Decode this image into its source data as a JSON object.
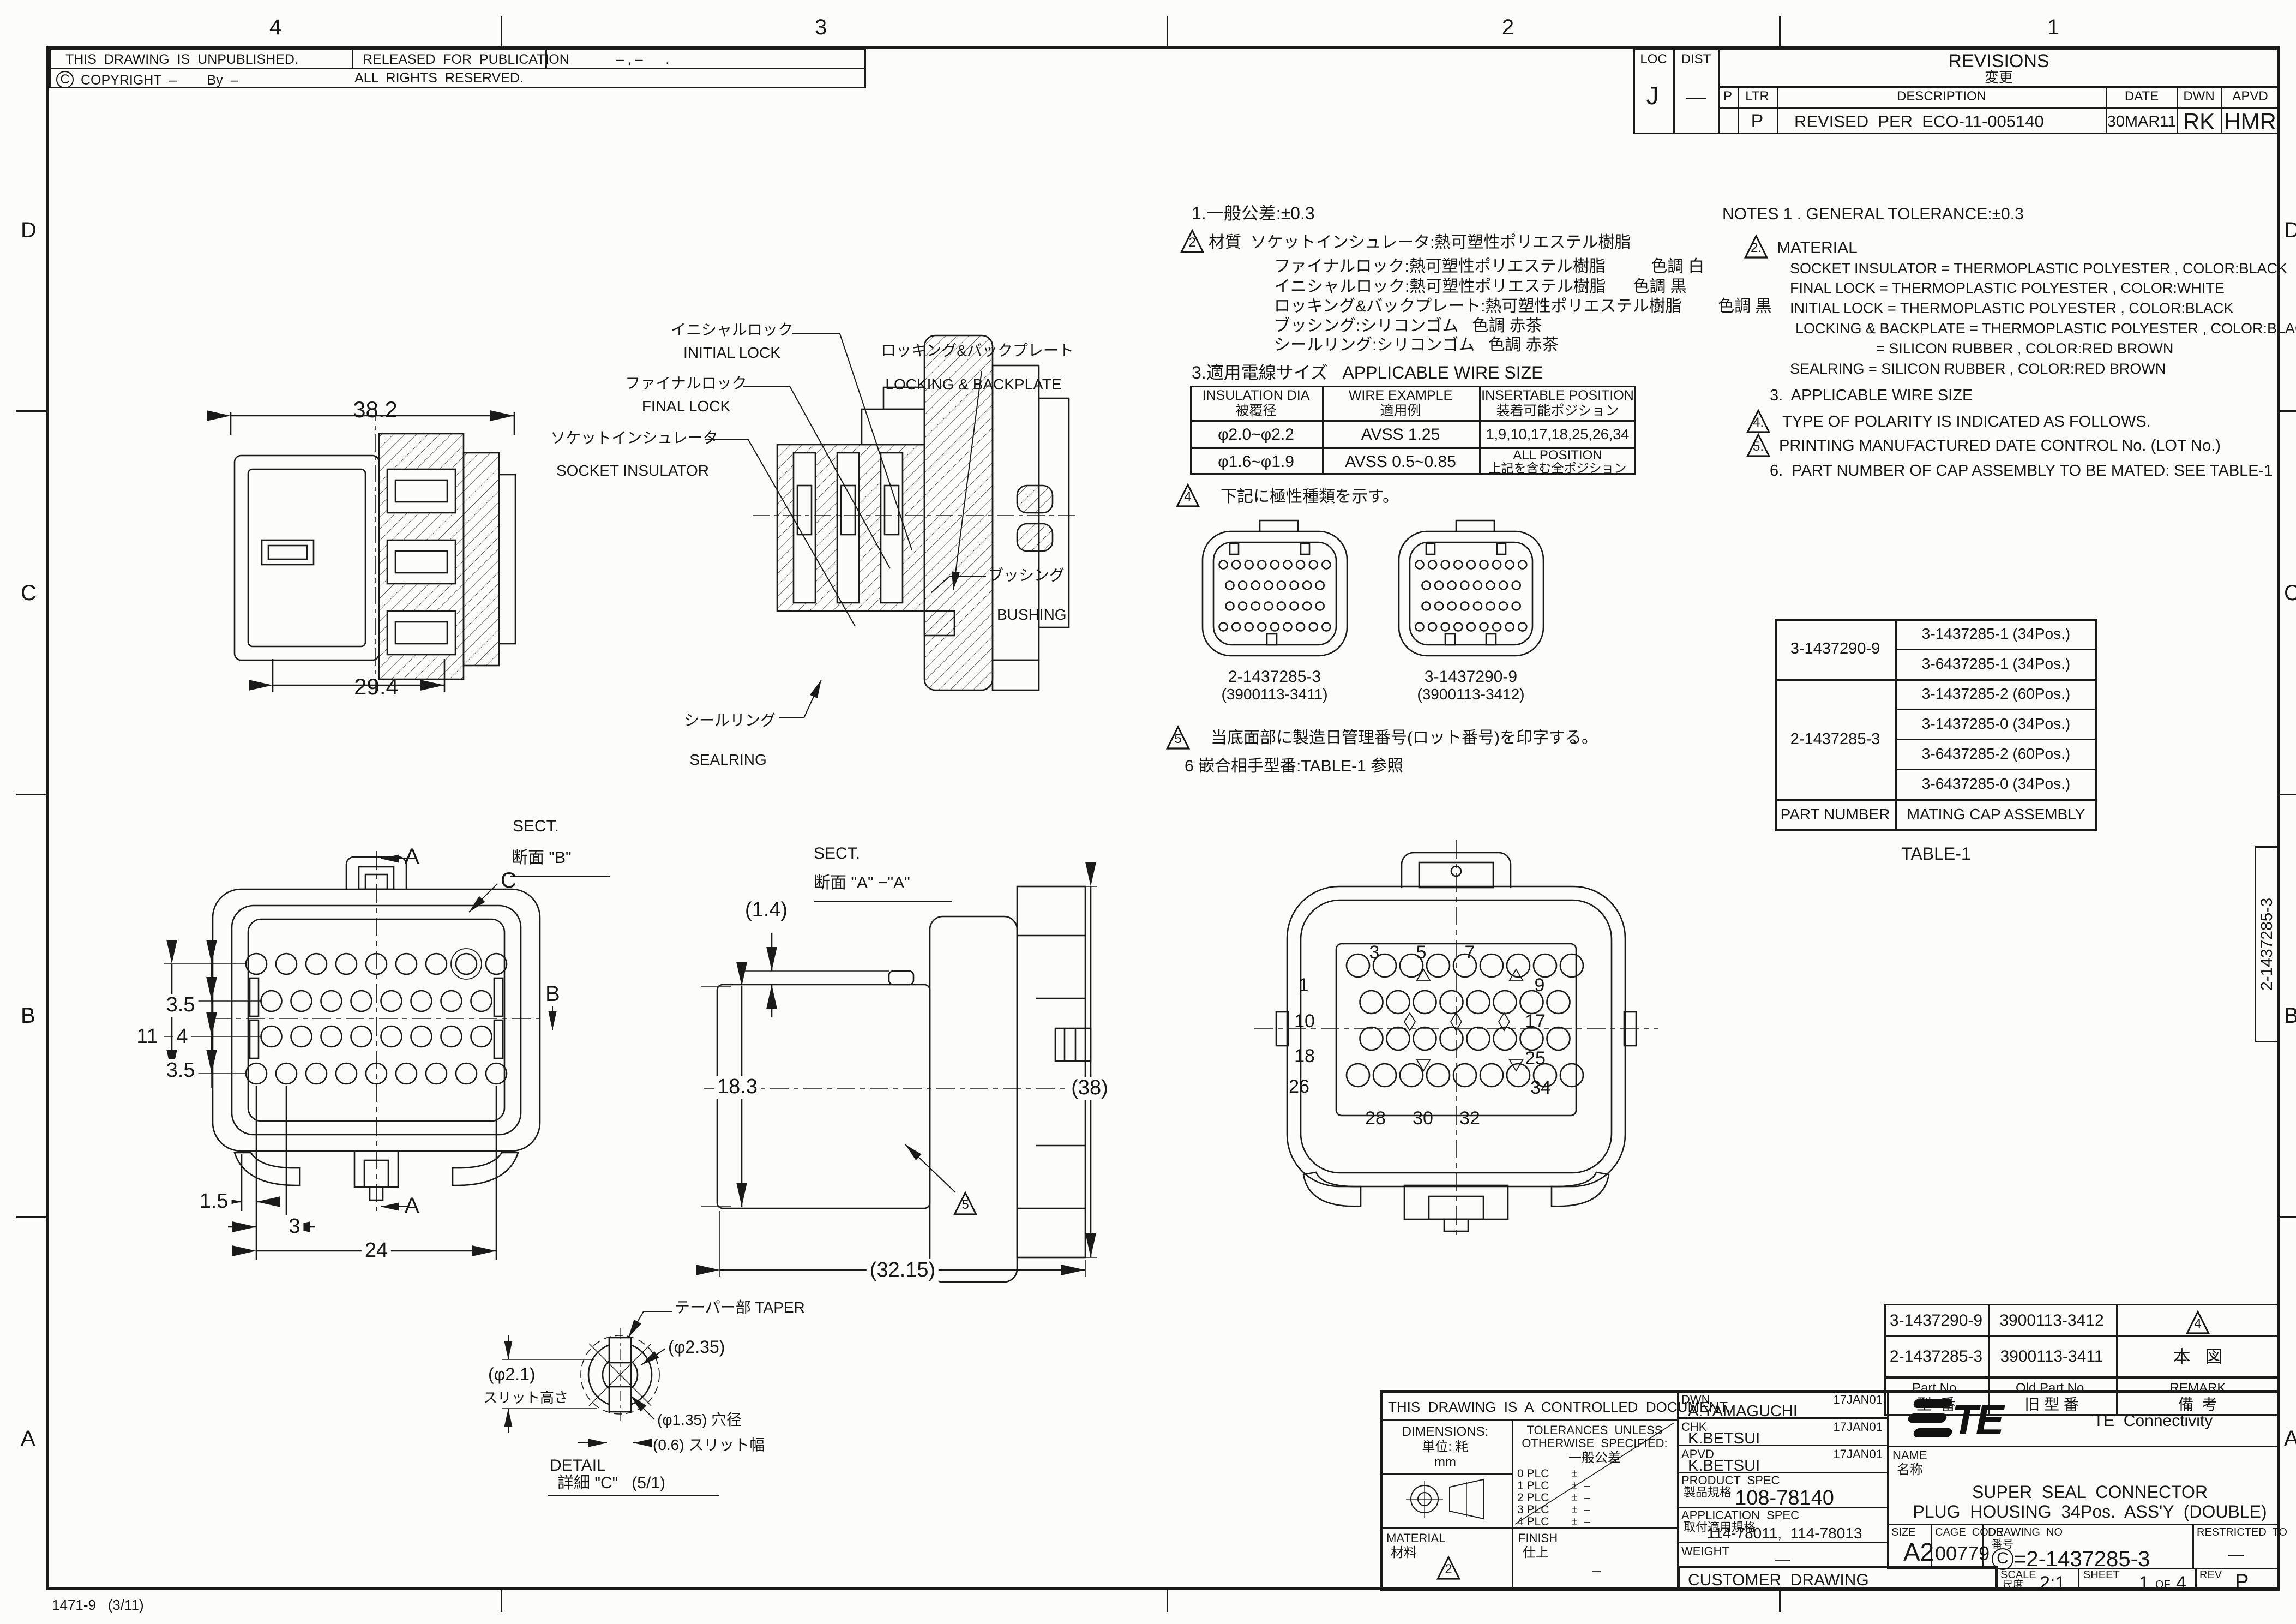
{
  "sheet": {
    "zones_top": [
      "4",
      "3",
      "2",
      "1"
    ],
    "zones_left": [
      "D",
      "C",
      "B",
      "A"
    ],
    "zones_right": [
      "D",
      "C",
      "B",
      "A"
    ],
    "form_note": "1471-9   (3/11)",
    "edge_label": "2-1437285-3"
  },
  "header": {
    "unpublished": "THIS  DRAWING  IS  UNPUBLISHED.",
    "released": "RELEASED  FOR  PUBLICATION",
    "released_value": "– , –      .",
    "copyright_c": "C",
    "copyright": "COPYRIGHT  –        By  –",
    "rights": "ALL  RIGHTS  RESERVED."
  },
  "revisions": {
    "loc_label": "LOC",
    "loc": "J",
    "dist_label": "DIST",
    "dist": "—",
    "title": "REVISIONS",
    "title_jp": "変更",
    "col_p": "P",
    "col_ltr": "LTR",
    "col_desc": "DESCRIPTION",
    "col_date": "DATE",
    "col_dwn": "DWN",
    "col_apvd": "APVD",
    "row": {
      "ltr": "P",
      "desc": "REVISED  PER  ECO-11-005140",
      "date": "30MAR11",
      "dwn": "RK",
      "apvd": "HMR"
    }
  },
  "notes_jp": {
    "n1": "1.一般公差:±0.3",
    "n2_flag": "2",
    "n2": "材質  ソケットインシュレータ:熱可塑性ポリエステル樹脂",
    "n2a": "ファイナルロック:熱可塑性ポリエステル樹脂          色調 白",
    "n2b": "イニシャルロック:熱可塑性ポリエステル樹脂      色調 黒",
    "n2c": "ロッキング&バックプレート:熱可塑性ポリエステル樹脂        色調 黒",
    "n2d": "ブッシング:シリコンゴム   色調 赤茶",
    "n2e": "シールリング:シリコンゴム   色調 赤茶",
    "n3": "3.適用電線サイズ   APPLICABLE WIRE SIZE",
    "n4_flag": "4",
    "n4": "下記に極性種類を示す。",
    "n5_flag": "5",
    "n5": "当底面部に製造日管理番号(ロット番号)を印字する。",
    "n6": "6 嵌合相手型番:TABLE-1 参照"
  },
  "wire_table": {
    "h1a": "INSULATION DIA",
    "h1b": "被覆径",
    "h2a": "WIRE EXAMPLE",
    "h2b": "適用例",
    "h3a": "INSERTABLE POSITION",
    "h3b": "装着可能ポジション",
    "r1c1": "φ2.0~φ2.2",
    "r1c2": "AVSS 1.25",
    "r1c3": "1,9,10,17,18,25,26,34",
    "r2c1": "φ1.6~φ1.9",
    "r2c2": "AVSS 0.5~0.85",
    "r2c3a": "ALL POSITION",
    "r2c3b": "上記を含む全ポジション"
  },
  "polarity": {
    "left_pn": "2-1437285-3",
    "left_old": "(3900113-3411)",
    "right_pn": "3-1437290-9",
    "right_old": "(3900113-3412)"
  },
  "notes_en": {
    "n1": "NOTES 1 . GENERAL TOLERANCE:±0.3",
    "n2_flag": "2.",
    "n2": "MATERIAL",
    "m1": "SOCKET INSULATOR = THERMOPLASTIC POLYESTER , COLOR:BLACK",
    "m2": "FINAL LOCK = THERMOPLASTIC POLYESTER , COLOR:WHITE",
    "m3": "INITIAL LOCK = THERMOPLASTIC POLYESTER , COLOR:BLACK",
    "m4": "LOCKING & BACKPLATE = THERMOPLASTIC POLYESTER , COLOR:BLACK",
    "m5": "= SILICON RUBBER , COLOR:RED BROWN",
    "m6": "SEALRING = SILICON RUBBER , COLOR:RED BROWN",
    "n3": "3.  APPLICABLE WIRE SIZE",
    "n4_flag": "4.",
    "n4": "TYPE OF POLARITY IS INDICATED AS FOLLOWS.",
    "n5_flag": "5.",
    "n5": "PRINTING MANUFACTURED DATE CONTROL No. (LOT No.)",
    "n6": "6.  PART NUMBER OF CAP ASSEMBLY TO BE MATED: SEE TABLE-1"
  },
  "table1": {
    "group1_pn": "3-1437290-9",
    "group2_pn": "2-1437285-3",
    "caps": [
      "3-1437285-1 (34Pos.)",
      "3-6437285-1 (34Pos.)",
      "3-1437285-2 (60Pos.)",
      "3-1437285-0 (34Pos.)",
      "3-6437285-2 (60Pos.)",
      "3-6437285-0 (34Pos.)"
    ],
    "footer_left": "PART NUMBER",
    "footer_right": "MATING CAP ASSEMBLY",
    "caption": "TABLE-1"
  },
  "callouts": {
    "initial_jp": "イニシャルロック",
    "initial_en": "INITIAL LOCK",
    "final_jp": "ファイナルロック",
    "final_en": "FINAL LOCK",
    "socket_jp": "ソケットインシュレータ",
    "socket_en": "SOCKET INSULATOR",
    "locking_jp": "ロッキング&バックプレート",
    "locking_en": "LOCKING & BACKPLATE",
    "bushing_jp": "ブッシング",
    "bushing_en": "BUSHING",
    "sealring_jp": "シールリング",
    "sealring_en": "SEALRING",
    "taper": "テーパー部 TAPER"
  },
  "sect_b": {
    "label1": "SECT.",
    "label2": "断面 \"B\"",
    "dim_top": "38.2",
    "dim_bottom": "29.4"
  },
  "sect_aa": {
    "label1": "SECT.",
    "label2": "断面 \"A\" −\"A\""
  },
  "front_view": {
    "d35a": "3.5",
    "d11": "11",
    "d4": "4",
    "d35b": "3.5",
    "d15": "1.5",
    "d3": "3",
    "d24": "24",
    "a_top": "A",
    "a_bottom": "A",
    "b": "B",
    "c": "C"
  },
  "side_view": {
    "d14": "(1.4)",
    "d183": "18.3",
    "d38": "(38)",
    "d3215": "(32.15)",
    "flag": "5"
  },
  "rear_view": {
    "p1": "1",
    "p3": "3",
    "p5": "5",
    "p7": "7",
    "p9": "9",
    "p10": "10",
    "p17": "17",
    "p18": "18",
    "p25": "25",
    "p26": "26",
    "p34": "34",
    "p28": "28",
    "p30": "30",
    "p32": "32"
  },
  "detail_c": {
    "d235": "(φ2.35)",
    "d21": "(φ2.1)",
    "slit_h": "スリット高さ",
    "d135": "(φ1.35) 穴径",
    "d06": "(0.6) スリット幅",
    "label1": "DETAIL",
    "label2": "詳細 \"C\"   (5/1)"
  },
  "part_table": {
    "r1c1": "3-1437290-9",
    "r1c2": "3900113-3412",
    "r1_flag": "4",
    "r2c1": "2-1437285-3",
    "r2c2": "3900113-3411",
    "r2c3": "本   図",
    "h1a": "Part No.",
    "h1b": "型  番",
    "h2a": "Old Part No.",
    "h2b": "旧 型 番",
    "h3a": "REMARK",
    "h3b": "備  考"
  },
  "title_block": {
    "controlled": "THIS  DRAWING  IS  A  CONTROLLED  DOCUMENT.",
    "dwn_label": "DWN",
    "dwn_name": "A.YAMAGUCHI",
    "dwn_date": "17JAN01",
    "chk_label": "CHK",
    "chk_name": "K.BETSUI",
    "chk_date": "17JAN01",
    "apvd_label": "APVD",
    "apvd_name": "K.BETSUI",
    "apvd_date": "17JAN01",
    "dim_label": "DIMENSIONS:",
    "units_jp": "単位: 粍",
    "units": "mm",
    "tol1": "TOLERANCES  UNLESS",
    "tol2": "OTHERWISE  SPECIFIED:",
    "tol3": "一般公差",
    "plc0": "0 PLC       ±",
    "plc1": "1 PLC       ±  –",
    "plc2": "2 PLC       ±  –",
    "plc3": "3 PLC       ±  –",
    "plc4": "4 PLC       ±  –",
    "angles": "ANGLES            ±  –",
    "material_label": "MATERIAL",
    "material_jp": "材料",
    "material_flag": "2",
    "finish_label": "FINISH",
    "finish_jp": "仕上",
    "finish_value": "–",
    "product_label": "PRODUCT  SPEC",
    "product_jp": "製品規格",
    "product": "108-78140",
    "app_label": "APPLICATION  SPEC",
    "app_jp": "取付適用規格",
    "app": "114-78011,  114-78013",
    "weight_label": "WEIGHT",
    "weight": "—",
    "customer": "CUSTOMER  DRAWING",
    "brand": "TE",
    "company": "TE  Connectivity",
    "name_label": "NAME",
    "name_jp": "名称",
    "title1": "SUPER  SEAL  CONNECTOR",
    "title2": "PLUG  HOUSING  34Pos.  ASS'Y  (DOUBLE)",
    "size_label": "SIZE",
    "size": "A2",
    "cage_label": "CAGE  CODE",
    "cage": "00779",
    "dwg_label": "DRAWING  NO",
    "dwg_jp": "番号",
    "dwg_c": "C",
    "dwg_no": "=2-1437285-3",
    "restricted_label": "RESTRICTED  TO",
    "restricted": "—",
    "scale_label": "SCALE",
    "scale_jp": "尺度",
    "scale": "2:1",
    "sheet_label": "SHEET",
    "sheet_no": "1",
    "sheet_of": "OF",
    "sheet_total": "4",
    "rev_label": "REV",
    "rev": "P"
  }
}
